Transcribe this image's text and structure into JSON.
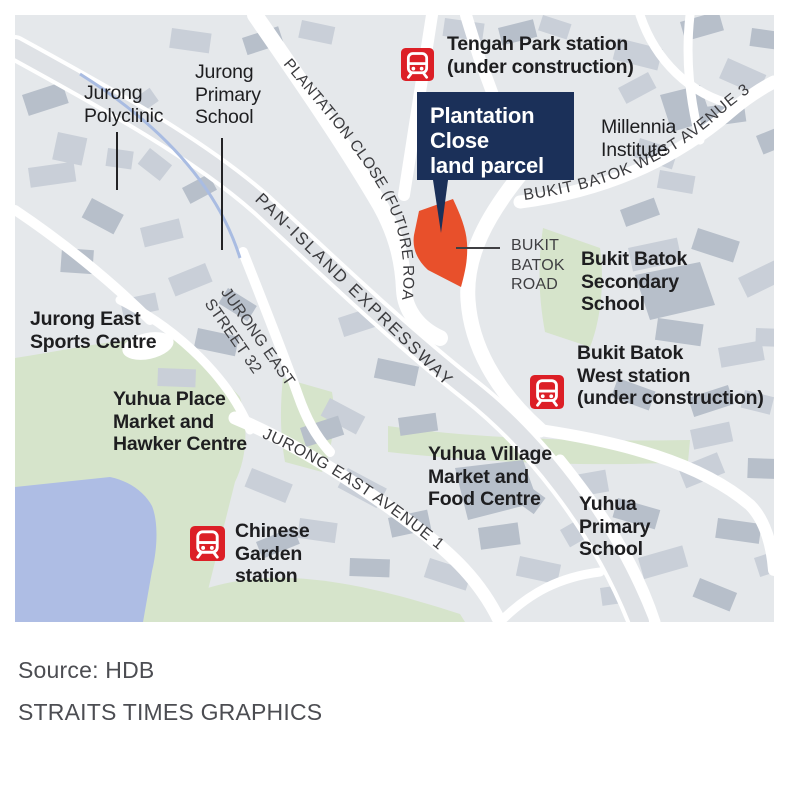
{
  "colors": {
    "map_background": "#e5e8eb",
    "building_gray": "#c9cfd8",
    "building_dark_gray": "#b7bfca",
    "road_white": "#ffffff",
    "expressway_gray": "#dfe2e6",
    "green_area": "#d6e4cb",
    "water_blue": "#aebde4",
    "stream_blue": "#a9bce2",
    "parcel_orange": "#e8502b",
    "callout_navy": "#1b3059",
    "mrt_red": "#dc1f26",
    "label_black": "#1e1e20",
    "source_gray": "#4c4d52"
  },
  "callout": {
    "lines": [
      "Plantation",
      "Close",
      "land parcel"
    ]
  },
  "stations": {
    "tengah": {
      "lines": [
        "Tengah Park station",
        "(under construction)"
      ]
    },
    "bukit_batok_west": {
      "lines": [
        "Bukit Batok",
        "West station",
        "(under construction)"
      ]
    },
    "chinese_garden": {
      "lines": [
        "Chinese",
        "Garden",
        "station"
      ]
    }
  },
  "places": {
    "jurong_polyclinic": {
      "lines": [
        "Jurong",
        "Polyclinic"
      ]
    },
    "jurong_primary": {
      "lines": [
        "Jurong",
        "Primary",
        "School"
      ]
    },
    "millennia": {
      "lines": [
        "Millennia",
        "Institute"
      ]
    },
    "bukit_batok_secondary": {
      "lines": [
        "Bukit Batok",
        "Secondary",
        "School"
      ]
    },
    "jurong_east_sports": {
      "lines": [
        "Jurong East",
        "Sports Centre"
      ]
    },
    "yuhua_place": {
      "lines": [
        "Yuhua Place",
        "Market and",
        "Hawker Centre"
      ]
    },
    "yuhua_village": {
      "lines": [
        "Yuhua Village",
        "Market and",
        "Food Centre"
      ]
    },
    "yuhua_primary": {
      "lines": [
        "Yuhua",
        "Primary",
        "School"
      ]
    }
  },
  "roads": {
    "plantation_close": "PLANTATION CLOSE (FUTURE ROAD)",
    "pan_island": "PAN-ISLAND EXPRESSWAY",
    "bukit_batok_west_ave3": "BUKIT BATOK WEST AVENUE 3",
    "jurong_east_avenue1": "JURONG EAST AVENUE 1",
    "jurong_east_street32": {
      "lines": [
        "JURONG EAST",
        "STREET 32"
      ]
    },
    "bukit_batok_road": {
      "lines": [
        "BUKIT",
        "BATOK",
        "ROAD"
      ]
    }
  },
  "footer": {
    "source": "Source: HDB",
    "credit": "STRAITS TIMES GRAPHICS"
  }
}
